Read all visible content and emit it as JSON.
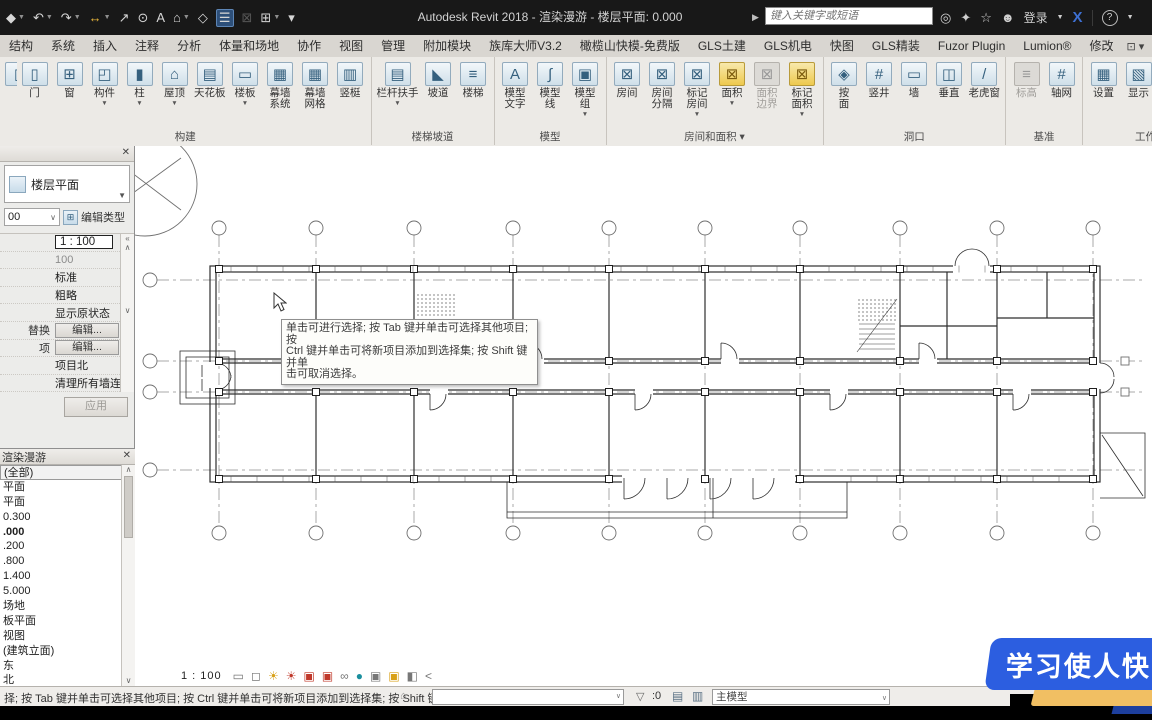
{
  "window": {
    "title": "Autodesk Revit 2018 - 渲染漫游 - 楼层平面: 0.000",
    "search_placeholder": "键入关键字或短语",
    "sign_in_label": "登录"
  },
  "qat": [
    {
      "name": "app-menu-icon",
      "glyph": "◆",
      "caret": true
    },
    {
      "name": "undo-icon",
      "glyph": "↶",
      "caret": true
    },
    {
      "name": "redo-icon",
      "glyph": "↷",
      "caret": true
    },
    {
      "name": "measure-icon",
      "glyph": "↔",
      "caret": true,
      "tint": "yellow"
    },
    {
      "name": "aligned-dimension-icon",
      "glyph": "↗"
    },
    {
      "name": "tag-by-category-icon",
      "glyph": "⊙"
    },
    {
      "name": "text-icon",
      "glyph": "A"
    },
    {
      "name": "default-3d-view-icon",
      "glyph": "⌂",
      "caret": true
    },
    {
      "name": "section-icon",
      "glyph": "◇"
    },
    {
      "name": "thin-lines-icon",
      "glyph": "☰",
      "active": true
    },
    {
      "name": "close-hidden-windows-icon",
      "glyph": "⊠",
      "disabled": true
    },
    {
      "name": "switch-windows-icon",
      "glyph": "⊞",
      "caret": true
    },
    {
      "name": "customize-qat-icon",
      "glyph": "▾"
    }
  ],
  "titlebar_right": [
    {
      "name": "search-icon",
      "glyph": "◎"
    },
    {
      "name": "communication-center-icon",
      "glyph": "✦"
    },
    {
      "name": "favorites-icon",
      "glyph": "☆"
    },
    {
      "name": "user-icon",
      "glyph": "☻"
    }
  ],
  "tabs": [
    "结构",
    "系统",
    "插入",
    "注释",
    "分析",
    "体量和场地",
    "协作",
    "视图",
    "管理",
    "附加模块",
    "族库大师V3.2",
    "橄榄山快模-免费版",
    "GLS土建",
    "GLS机电",
    "快图",
    "GLS精装",
    "Fuzor Plugin",
    "Lumion®",
    "修改"
  ],
  "ribbon": {
    "groups": [
      {
        "label": "构建",
        "buttons": [
          {
            "label": "",
            "glyph": "▯",
            "cut": true
          },
          {
            "label": "门",
            "glyph": "▯"
          },
          {
            "label": "窗",
            "glyph": "⊞"
          },
          {
            "label": "构件",
            "glyph": "◰",
            "caret": true
          },
          {
            "label": "柱",
            "glyph": "▮",
            "caret": true
          },
          {
            "label": "屋顶",
            "glyph": "⌂",
            "caret": true
          },
          {
            "label": "天花板",
            "glyph": "▤"
          },
          {
            "label": "楼板",
            "glyph": "▭",
            "caret": true
          },
          {
            "label": "幕墙\n系统",
            "glyph": "▦"
          },
          {
            "label": "幕墙\n网格",
            "glyph": "▦"
          },
          {
            "label": "竖梃",
            "glyph": "▥"
          }
        ]
      },
      {
        "label": "楼梯坡道",
        "buttons": [
          {
            "label": "栏杆扶手",
            "glyph": "▤",
            "caret": true
          },
          {
            "label": "坡道",
            "glyph": "◣"
          },
          {
            "label": "楼梯",
            "glyph": "≡"
          }
        ]
      },
      {
        "label": "模型",
        "buttons": [
          {
            "label": "模型\n文字",
            "glyph": "A"
          },
          {
            "label": "模型\n线",
            "glyph": "∫"
          },
          {
            "label": "模型\n组",
            "glyph": "▣",
            "caret": true
          }
        ]
      },
      {
        "label": "房间和面积 ▾",
        "buttons": [
          {
            "label": "房间",
            "glyph": "⊠"
          },
          {
            "label": "房间\n分隔",
            "glyph": "⊠"
          },
          {
            "label": "标记\n房间",
            "glyph": "⊠",
            "caret": true
          },
          {
            "label": "面积",
            "glyph": "⊠",
            "tint": "yellow",
            "caret": true
          },
          {
            "label": "面积\n边界",
            "glyph": "⊠",
            "disabled": true
          },
          {
            "label": "标记\n面积",
            "glyph": "⊠",
            "tint": "yellow",
            "caret": true
          }
        ]
      },
      {
        "label": "洞口",
        "buttons": [
          {
            "label": "按\n面",
            "glyph": "◈"
          },
          {
            "label": "竖井",
            "glyph": "#"
          },
          {
            "label": "墙",
            "glyph": "▭"
          },
          {
            "label": "垂直",
            "glyph": "◫"
          },
          {
            "label": "老虎窗",
            "glyph": "/"
          }
        ]
      },
      {
        "label": "基准",
        "buttons": [
          {
            "label": "标高",
            "glyph": "≡",
            "disabled": true
          },
          {
            "label": "轴网",
            "glyph": "#"
          }
        ]
      },
      {
        "label": "工作平面",
        "buttons": [
          {
            "label": "设置",
            "glyph": "▦"
          },
          {
            "label": "显示",
            "glyph": "▧"
          },
          {
            "label": "参照\n平面",
            "glyph": "▱"
          },
          {
            "label": "查看",
            "glyph": "▣"
          }
        ]
      }
    ]
  },
  "properties": {
    "close_glyph": "✕",
    "type_selector_label": "楼层平面",
    "instance_value": "00",
    "edit_type_label": "编辑类型",
    "rows": [
      {
        "label": "",
        "value": "1 : 100",
        "style": "box"
      },
      {
        "label": "",
        "value": "100",
        "style": "grey"
      },
      {
        "label": "",
        "value": "标准",
        "style": ""
      },
      {
        "label": "",
        "value": "粗略",
        "style": ""
      },
      {
        "label": "",
        "value": "显示原状态",
        "style": ""
      },
      {
        "label": "替换",
        "value": "编辑...",
        "style": "button"
      },
      {
        "label": "项",
        "value": "编辑...",
        "style": "button"
      },
      {
        "label": "",
        "value": "项目北",
        "style": ""
      },
      {
        "label": "",
        "value": "清理所有墙连接",
        "style": ""
      }
    ],
    "apply_label": "应用"
  },
  "browser": {
    "title": "渲染漫游",
    "close_glyph": "✕",
    "items": [
      {
        "text": "(全部)",
        "selected": true
      },
      {
        "text": "平面"
      },
      {
        "text": "平面"
      },
      {
        "text": "0.300"
      },
      {
        "text": ".000",
        "bold": true
      },
      {
        "text": ".200"
      },
      {
        "text": ".800"
      },
      {
        "text": "1.400"
      },
      {
        "text": "5.000"
      },
      {
        "text": "场地"
      },
      {
        "text": "板平面"
      },
      {
        "text": "视图"
      },
      {
        "text": "(建筑立面)"
      },
      {
        "text": "东"
      },
      {
        "text": "北"
      }
    ]
  },
  "canvas": {
    "view_scale": "1 : 100",
    "tooltip_lines": [
      "单击可进行选择; 按 Tab 键并单击可选择其他项目; 按",
      "Ctrl 键并单击可将新项目添加到选择集; 按 Shift 键并单",
      "击可取消选择。"
    ],
    "vcb_icons": [
      {
        "name": "visual-style-icon",
        "glyph": "▭",
        "color": "grey"
      },
      {
        "name": "detail-level-icon",
        "glyph": "◻",
        "color": "grey"
      },
      {
        "name": "sun-path-icon",
        "glyph": "☀",
        "color": "yel"
      },
      {
        "name": "shadows-icon",
        "glyph": "☀",
        "color": "red"
      },
      {
        "name": "crop-view-icon",
        "glyph": "▣",
        "color": "red"
      },
      {
        "name": "show-crop-region-icon",
        "glyph": "▣",
        "color": "red"
      },
      {
        "name": "temporary-hide-isolate-icon",
        "glyph": "∞",
        "color": "grey"
      },
      {
        "name": "reveal-hidden-elements-icon",
        "glyph": "●",
        "color": "teal"
      },
      {
        "name": "temporary-view-properties-icon",
        "glyph": "▣",
        "color": "grey"
      },
      {
        "name": "displacement-sets-icon",
        "glyph": "▣",
        "color": "yel"
      },
      {
        "name": "selection-box-icon",
        "glyph": "◧",
        "color": "grey"
      },
      {
        "name": "collapse-arrow-icon",
        "glyph": "<",
        "color": "grey"
      }
    ]
  },
  "status_bar": {
    "message": "择; 按 Tab 键并单击可选择其他项目; 按 Ctrl 键并单击可将新项目添加到选择集; 按 Shift 键并单击可",
    "selection_count": ":0",
    "design_option": "主模型"
  },
  "banner": {
    "text": "学习使人快",
    "blue": "#2c5ee0",
    "yellow": "#f1bf63",
    "navy": "#1d3f9e"
  }
}
